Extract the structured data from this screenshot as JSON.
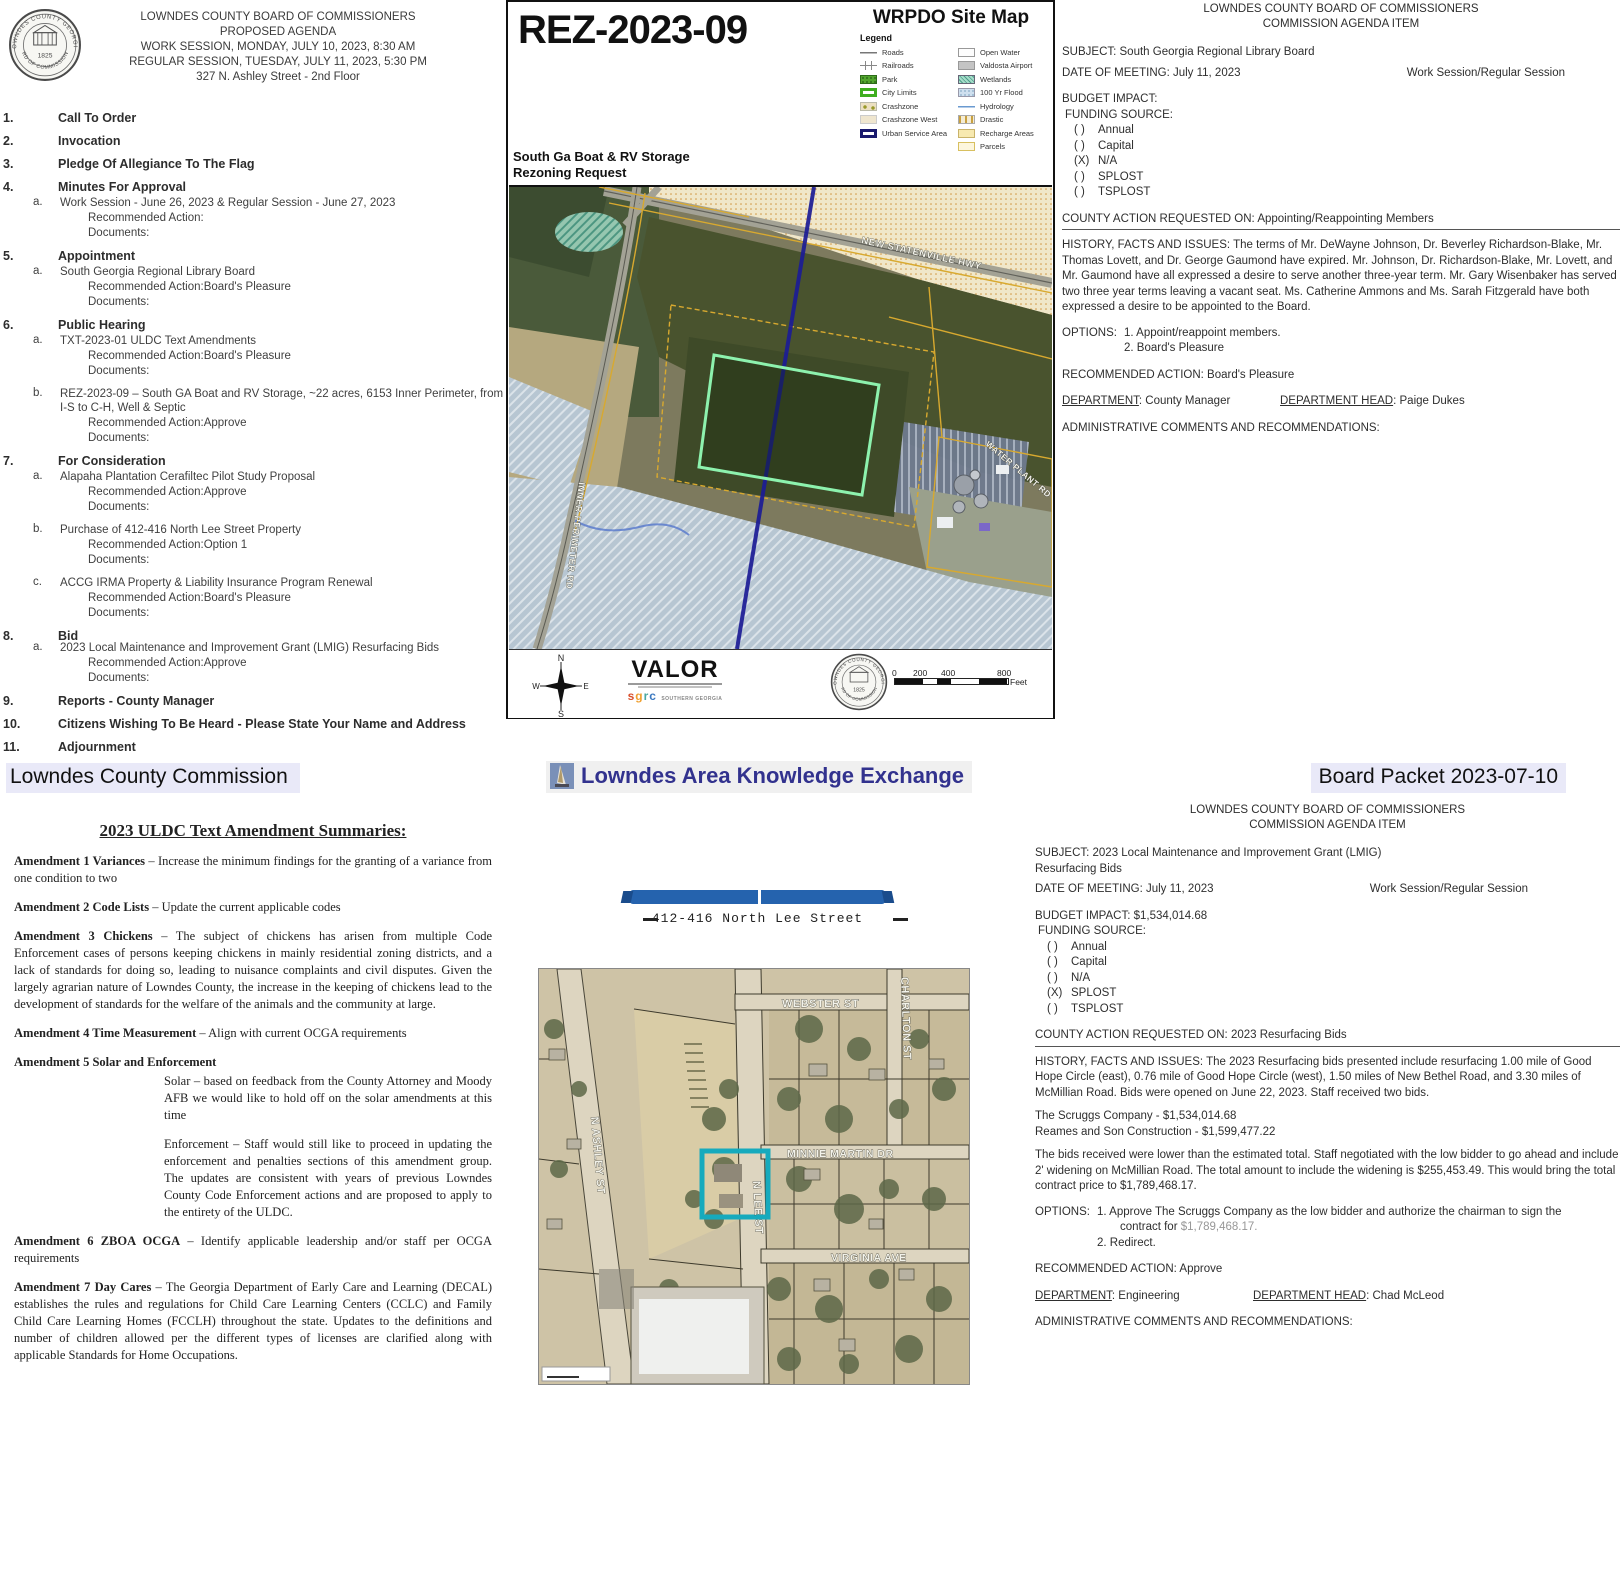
{
  "banner": {
    "left": "Lowndes County Commission",
    "center": "Lowndes Area Knowledge Exchange",
    "right": "Board Packet 2023-07-10"
  },
  "agenda": {
    "header": {
      "l1": "LOWNDES COUNTY BOARD OF COMMISSIONERS",
      "l2": "PROPOSED AGENDA",
      "l3": "WORK SESSION, MONDAY, JULY 10, 2023, 8:30 AM",
      "l4": "REGULAR SESSION, TUESDAY, JULY 11, 2023, 5:30 PM",
      "l5": "327 N. Ashley Street - 2nd Floor"
    },
    "seal": {
      "arc_top": "LOWNDES COUNTY GEORGIA",
      "arc_bottom": "BOARD OF COMMISSIONERS",
      "year": "1825"
    },
    "labels": {
      "recommended_action": "Recommended Action:",
      "documents": "Documents:"
    },
    "items": [
      {
        "num": "1.",
        "title": "Call To Order"
      },
      {
        "num": "2.",
        "title": "Invocation"
      },
      {
        "num": "3.",
        "title": "Pledge Of Allegiance To The Flag"
      },
      {
        "num": "4.",
        "title": "Minutes For Approval",
        "subs": [
          {
            "letter": "a.",
            "text": "Work Session - June 26, 2023 & Regular Session - June 27, 2023",
            "action": ""
          }
        ]
      },
      {
        "num": "5.",
        "title": "Appointment",
        "subs": [
          {
            "letter": "a.",
            "text": "South Georgia Regional Library Board",
            "action": "Board's Pleasure"
          }
        ]
      },
      {
        "num": "6.",
        "title": "Public Hearing",
        "subs": [
          {
            "letter": "a.",
            "text": "TXT-2023-01 ULDC Text Amendments",
            "action": "Board's Pleasure"
          },
          {
            "letter": "b.",
            "text": "REZ-2023-09 – South GA Boat and RV Storage, ~22 acres, 6153 Inner Perimeter, from I-S to C-H, Well & Septic",
            "action": "Approve"
          }
        ]
      },
      {
        "num": "7.",
        "title": "For Consideration",
        "subs": [
          {
            "letter": "a.",
            "text": "Alapaha Plantation Cerafiltec Pilot Study Proposal",
            "action": "Approve"
          },
          {
            "letter": "b.",
            "text": "Purchase of 412-416 North Lee Street Property",
            "action": "Option 1"
          },
          {
            "letter": "c.",
            "text": "ACCG IRMA Property & Liability Insurance Program Renewal",
            "action": "Board's Pleasure"
          }
        ]
      },
      {
        "num": "8.",
        "title": "Bid",
        "subs": [
          {
            "letter": "a.",
            "text": "2023 Local Maintenance and Improvement Grant (LMIG) Resurfacing Bids",
            "action": "Approve"
          }
        ]
      },
      {
        "num": "9.",
        "title": "Reports - County Manager"
      },
      {
        "num": "10.",
        "title": "Citizens Wishing To Be Heard - Please State Your Name and Address"
      },
      {
        "num": "11.",
        "title": "Adjournment"
      }
    ]
  },
  "sitemap": {
    "rez_number": "REZ-2023-09",
    "title": "WRPDO Site Map",
    "legend_title": "Legend",
    "legend_left": [
      "Roads",
      "Railroads",
      "Park",
      "City Limits",
      "Crashzone",
      "Crashzone West",
      "Urban Service Area"
    ],
    "legend_right": [
      "Open Water",
      "Valdosta Airport",
      "Wetlands",
      "100 Yr Flood",
      "Hydrology",
      "Drastic",
      "Recharge Areas",
      "Parcels"
    ],
    "subtitle1": "South Ga Boat & RV Storage",
    "subtitle2": "Rezoning Request",
    "labels": {
      "highway": "NEW STATENVILLE HWY",
      "road": "INNER PERIMETER RD",
      "water_plant": "WATER PLANT RD"
    },
    "compass": {
      "n": "N",
      "e": "E",
      "s": "S",
      "w": "W"
    },
    "valor": {
      "name": "VALOR",
      "sgrc": [
        "s",
        "g",
        "r",
        "c"
      ],
      "org": "SOUTHERN GEORGIA"
    },
    "scale": {
      "t0": "0",
      "t200": "200",
      "t400": "400",
      "t800": "800",
      "unit": "Feet"
    }
  },
  "doc_library": {
    "header1": "LOWNDES COUNTY BOARD OF COMMISSIONERS",
    "header2": "COMMISSION AGENDA ITEM",
    "subject": "SUBJECT: South Georgia Regional Library Board",
    "date_line": "DATE OF MEETING: July 11, 2023",
    "session": "Work Session/Regular Session",
    "budget": "BUDGET IMPACT:",
    "funding_label": "FUNDING SOURCE:",
    "funding": [
      {
        "mark": "( )",
        "label": "Annual"
      },
      {
        "mark": "( )",
        "label": "Capital"
      },
      {
        "mark": "(X)",
        "label": "N/A"
      },
      {
        "mark": "( )",
        "label": "SPLOST"
      },
      {
        "mark": "( )",
        "label": "TSPLOST"
      }
    ],
    "county_action": "COUNTY ACTION REQUESTED ON: Appointing/Reappointing Members",
    "history": "HISTORY, FACTS AND ISSUES: The terms of Mr. DeWayne Johnson, Dr. Beverley Richardson-Blake, Mr. Thomas Lovett, and Dr. George Gaumond have expired.  Mr. Johnson, Dr. Richardson-Blake, Mr. Lovett, and Mr. Gaumond have all expressed a desire to serve another three-year term.  Mr. Gary Wisenbaker has served two three year terms leaving a vacant seat.  Ms. Catherine Ammons and Ms. Sarah Fitzgerald have both expressed a desire to be appointed to the Board.",
    "options_label": "OPTIONS:",
    "option1": "1. Appoint/reappoint members.",
    "option2": "2. Board's Pleasure",
    "recommended": "RECOMMENDED ACTION: Board's Pleasure",
    "dept_label": "DEPARTMENT",
    "dept_value": ": County Manager",
    "head_label": "DEPARTMENT HEAD",
    "head_value": ": Paige Dukes",
    "admin": "ADMINISTRATIVE COMMENTS AND RECOMMENDATIONS:"
  },
  "doc_lmig": {
    "header1": "LOWNDES COUNTY BOARD OF COMMISSIONERS",
    "header2": "COMMISSION AGENDA ITEM",
    "subject1": "SUBJECT: 2023 Local Maintenance and Improvement Grant (LMIG)",
    "subject2": "Resurfacing Bids",
    "date_line": "DATE OF MEETING: July 11, 2023",
    "session": "Work Session/Regular Session",
    "budget": "BUDGET IMPACT: $1,534,014.68",
    "funding_label": "FUNDING SOURCE:",
    "funding": [
      {
        "mark": "( )",
        "label": "Annual"
      },
      {
        "mark": "( )",
        "label": "Capital"
      },
      {
        "mark": "( )",
        "label": "N/A"
      },
      {
        "mark": "(X)",
        "label": "SPLOST"
      },
      {
        "mark": "( )",
        "label": "TSPLOST"
      }
    ],
    "county_action": "COUNTY ACTION REQUESTED ON: 2023 Resurfacing Bids",
    "history": "HISTORY, FACTS AND ISSUES: The 2023 Resurfacing bids presented include resurfacing 1.00 mile of Good Hope Circle (east), 0.76 mile of Good Hope Circle (west), 1.50 miles of New Bethel Road, and 3.30 miles of McMillian Road. Bids were opened on June 22, 2023. Staff received two bids.",
    "bid1": "The Scruggs Company - $1,534,014.68",
    "bid2": "Reames and Son Construction - $1,599,477.22",
    "para2": "The bids received were lower than the estimated total. Staff negotiated with the low bidder to go ahead and include 2' widening on McMillian Road. The total amount to include the widening is $255,453.49. This would bring the total contract price to $1,789,468.17.",
    "options_label": "OPTIONS:",
    "option1a": "1.  Approve The Scruggs Company as the low bidder and authorize the chairman to sign the",
    "option1b": "contract for ",
    "option1_amount": "$1,789,468.17.",
    "option2": "2.  Redirect.",
    "recommended": "RECOMMENDED ACTION: Approve",
    "dept_label": "DEPARTMENT",
    "dept_value": ": Engineering",
    "head_label": "DEPARTMENT HEAD",
    "head_value": ": Chad McLeod",
    "admin": "ADMINISTRATIVE COMMENTS AND RECOMMENDATIONS:"
  },
  "uldc": {
    "title": "2023 ULDC Text Amendment Summaries:",
    "a1": {
      "lead": "Amendment 1 Variances",
      "rest": " – Increase the minimum findings for the granting of a variance from one condition to two"
    },
    "a2": {
      "lead": "Amendment 2 Code Lists",
      "rest": " – Update the current applicable codes"
    },
    "a3": {
      "lead": "Amendment 3 Chickens",
      "rest": " – The subject of chickens has arisen from multiple Code Enforcement cases of persons keeping chickens in mainly residential zoning districts, and a lack of standards for doing so, leading to nuisance complaints and civil disputes. Given the largely agrarian nature of Lowndes County, the increase in the keeping of chickens lead to the development of standards for the welfare of the animals and the community at large."
    },
    "a4": {
      "lead": "Amendment 4 Time Measurement",
      "rest": " – Align with current OCGA requirements"
    },
    "a5": {
      "lead": "Amendment 5 Solar and Enforcement",
      "sub1": "Solar – based on feedback from the County Attorney and Moody AFB we would like to hold off on the solar amendments at this time",
      "sub2": "Enforcement – Staff would still like to proceed in updating the enforcement and penalties sections of this amendment group.  The updates are consistent with years of previous Lowndes County Code Enforcement actions and are proposed to apply to the entirety of the ULDC."
    },
    "a6": {
      "lead": "Amendment 6 ZBOA OCGA",
      "rest": " – Identify applicable leadership and/or staff per OCGA requirements"
    },
    "a7": {
      "lead": "Amendment 7 Day Cares",
      "rest": " – The Georgia Department of Early Care and Learning (DECAL) establishes the rules and regulations for Child Care Learning Centers (CCLC) and Family Child Care Learning Homes (FCCLH) throughout the state. Updates to the definitions and number of children allowed per the different types of licenses are clarified along with applicable Standards for Home Occupations."
    }
  },
  "leemap": {
    "address": "412-416 North Lee Street",
    "streets": {
      "webster": "WEBSTER ST",
      "charlton": "CHARLTON ST",
      "ashley": "N ASHLEY ST",
      "lee": "N LEE ST",
      "minnie": "MINNIE MARTIN DR",
      "virginia": "VIRGINIA AVE"
    }
  }
}
